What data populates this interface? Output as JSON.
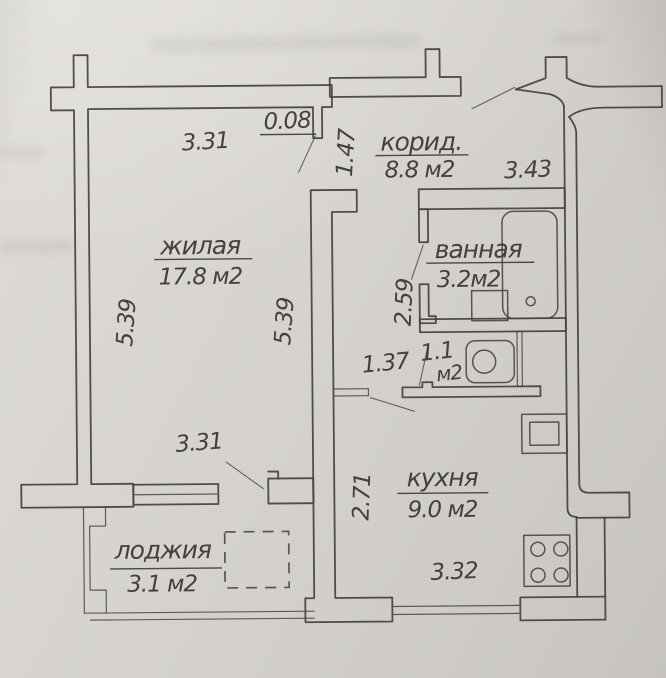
{
  "document": {
    "kind": "apartment floor plan (photographed technical drawing)"
  },
  "rooms": {
    "living": {
      "name": "жилая",
      "area": "17.8 м2"
    },
    "corridor": {
      "name": "корид.",
      "area": "8.8 м2"
    },
    "bathroom": {
      "name": "ванная",
      "area": "3.2м2"
    },
    "wc": {
      "area_value": "1.1",
      "area_unit": "м2"
    },
    "kitchen": {
      "name": "кухня",
      "area": "9.0 м2"
    },
    "loggia": {
      "name": "лоджия",
      "area": "3.1 м2"
    }
  },
  "dimensions": {
    "living_width_top": "3.31",
    "living_width_bottom": "3.31",
    "living_height_left": "5.39",
    "living_height_right": "5.39",
    "wall_stub": "0.08",
    "door_opening": "1.47",
    "corridor_width": "3.43",
    "corridor_depth": "2.59",
    "wc_width": "1.37",
    "kitchen_depth": "2.71",
    "kitchen_width": "3.32"
  },
  "colors": {
    "paper": "#d8d5d0",
    "ink": "#46423c"
  }
}
